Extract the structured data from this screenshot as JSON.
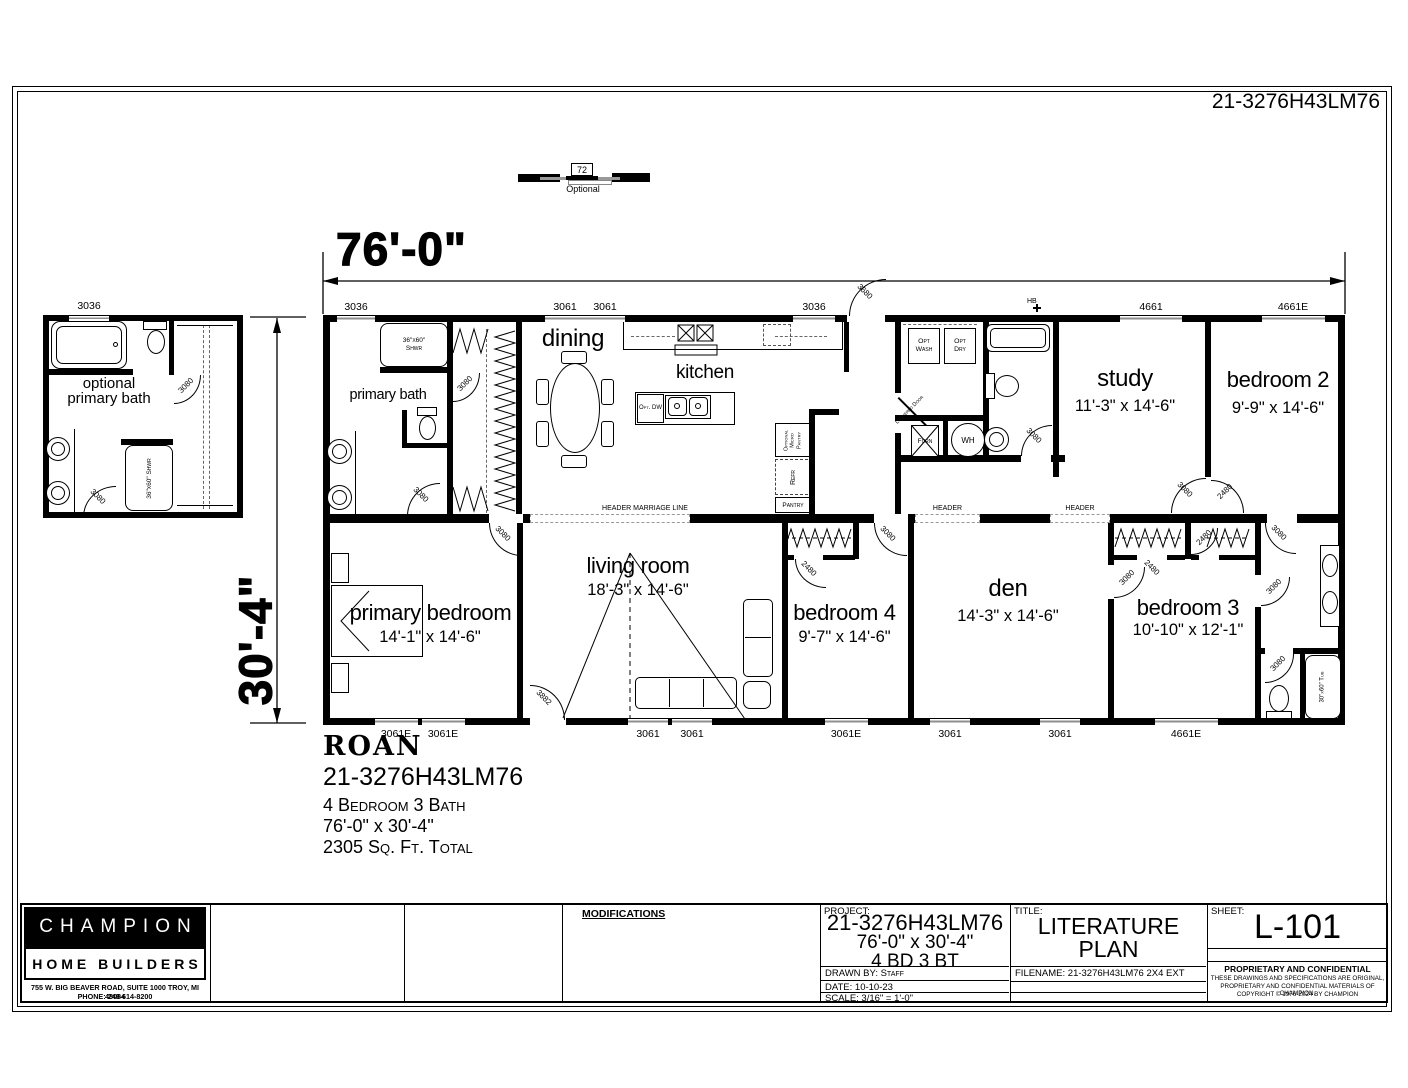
{
  "sheet": {
    "project_number": "21-3276H43LM76"
  },
  "top_detail": {
    "size": "72",
    "caption": "Optional"
  },
  "dims": {
    "width": "76'-0\"",
    "depth": "30'-4\""
  },
  "windows": {
    "w3036": "3036",
    "w3061": "3061",
    "w3061e": "3061E",
    "w4661": "4661",
    "w4661e": "4661E"
  },
  "doors": {
    "d3080": "3080",
    "d2480": "2480",
    "d3680": "3680",
    "d3882": "3882"
  },
  "marriage": {
    "header_marriage_line": "HEADER MARRIAGE LINE",
    "header": "HEADER"
  },
  "detail": {
    "label_line1": "optional",
    "label_line2": "primary bath"
  },
  "rooms": {
    "primary_bath": {
      "name": "primary bath"
    },
    "dining": {
      "name": "dining"
    },
    "kitchen": {
      "name": "kitchen"
    },
    "study": {
      "name": "study",
      "dims": "11'-3\" x 14'-6\""
    },
    "bedroom2": {
      "name": "bedroom 2",
      "dims": "9'-9\" x 14'-6\""
    },
    "primary_bedroom": {
      "name": "primary bedroom",
      "dims": "14'-1\" x 14'-6\""
    },
    "living": {
      "name": "living room",
      "dims": "18'-3\" x 14'-6\""
    },
    "bedroom4": {
      "name": "bedroom 4",
      "dims": "9'-7\" x 14'-6\""
    },
    "den": {
      "name": "den",
      "dims": "14'-3\" x 14'-6\""
    },
    "bedroom3": {
      "name": "bedroom 3",
      "dims": "10'-10\" x 12'-1\""
    }
  },
  "fixtures": {
    "shower_size": "36\"x60\"",
    "shower_name": "Shwr",
    "shower_full": "36\"x60\" Shwr",
    "tub_full": "30\"x60\" Tub",
    "opt_wash": "Opt Wash",
    "opt_dry": "Opt Dry",
    "furn": "Furn",
    "wh": "WH",
    "louvered_door": "Louvered Door",
    "micro_pantry": "Optional Micro Pantry",
    "refr": "Refr",
    "pantry": "Pantry",
    "opt_dw": "Opt. DW",
    "hb": "HB"
  },
  "info_block": {
    "model": "ROAN",
    "number": "21-3276H43LM76",
    "line1": "4 Bedroom 3 Bath",
    "line2": "76'-0\" x 30'-4\"",
    "line3": "2305 Sq. Ft. Total"
  },
  "title_block": {
    "company": {
      "name": "CHAMPION",
      "sub": "HOME BUILDERS",
      "address": "755 W. BIG BEAVER ROAD, SUITE 1000  TROY, MI  48084",
      "phone": "PHONE: 248-614-8200"
    },
    "modifications_label": "MODIFICATIONS",
    "project": {
      "label": "PROJECT:",
      "number": "21-3276H43LM76",
      "size": "76'-0\" x 30'-4\"",
      "bd_bt": "4 BD 3 BT",
      "drawn_by": "DRAWN BY: Staff",
      "date": "DATE: 10-10-23",
      "scale": "SCALE: 3/16\" = 1'-0\""
    },
    "title": {
      "label": "TITLE:",
      "line1": "LITERATURE",
      "line2": "PLAN",
      "filename": "FILENAME: 21-3276H43LM76  2X4 EXT"
    },
    "sheet": {
      "label": "SHEET:",
      "number": "L-101",
      "conf1": "PROPRIETARY AND CONFIDENTIAL",
      "conf2": "THESE DRAWINGS AND SPECIFICATIONS ARE ORIGINAL,",
      "conf3": "PROPRIETARY AND CONFIDENTIAL MATERIALS OF CHAMPION.",
      "conf4": "COPYRIGHT © 1976-2024 BY CHAMPION"
    }
  }
}
